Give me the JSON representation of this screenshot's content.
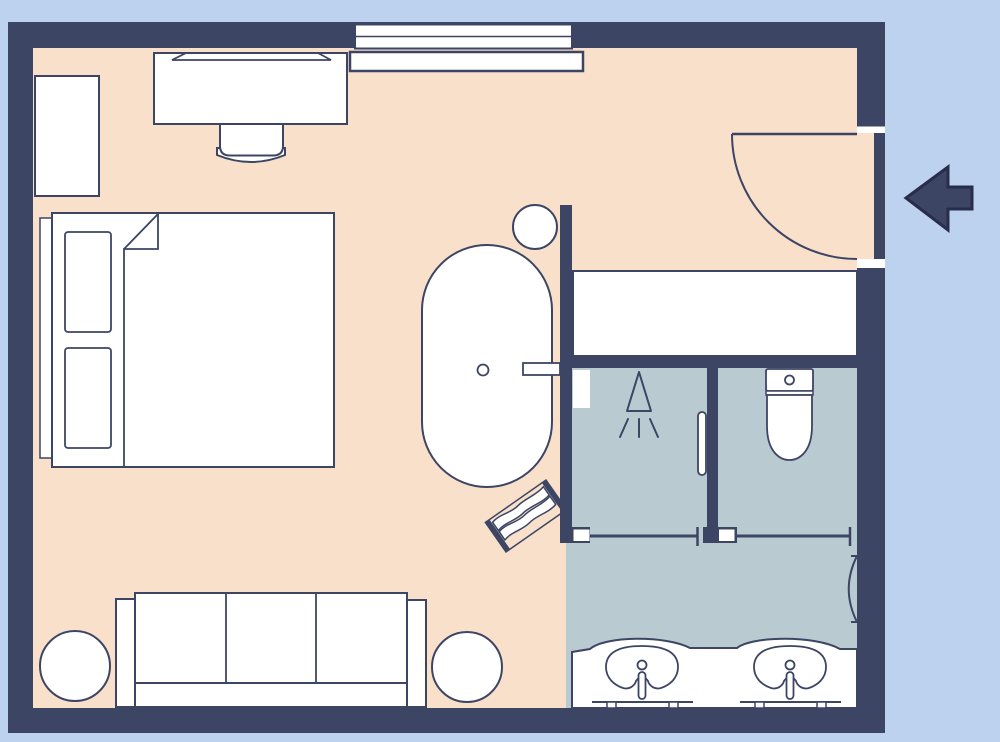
{
  "title": "apartment-floor-plan",
  "colors": {
    "outside": "#bdd2ee",
    "wall": "#3d4565",
    "floor_main": "#f8e0ca",
    "floor_bathroom": "#b9cad1",
    "furniture_fill": "#ffffff",
    "outline": "#3d4565",
    "arrow_outline": "#272d4a"
  },
  "rooms": [
    {
      "name": "bedroom-living-area",
      "floor": "peach",
      "furniture": [
        "dresser",
        "desk",
        "desk-chair",
        "window-shelf",
        "double-bed",
        "pillows",
        "folded-blanket",
        "sofa",
        "side-table-left",
        "side-table-right",
        "bathtub",
        "tub-side-stool",
        "tub-faucet-shelf",
        "bath-mat"
      ]
    },
    {
      "name": "entry-hall",
      "floor": "peach",
      "features": [
        "entry-swing-door"
      ]
    },
    {
      "name": "closet",
      "floor": "white",
      "features": []
    },
    {
      "name": "shower-room",
      "floor": "gray",
      "furniture": [
        "shower-head-symbol",
        "shower-niche",
        "door-handle"
      ],
      "features": [
        "sliding-door"
      ]
    },
    {
      "name": "wc-room",
      "floor": "gray",
      "furniture": [
        "toilet"
      ],
      "features": [
        "sliding-door"
      ]
    },
    {
      "name": "vanity-bathroom",
      "floor": "gray",
      "furniture": [
        "double-vanity-counter",
        "sink-left",
        "sink-right",
        "towel-rail"
      ]
    }
  ],
  "openings": {
    "window": {
      "wall": "top",
      "style": "double-line"
    },
    "entry_door": {
      "wall": "right",
      "type": "swing-door",
      "swing": "quarter-arc-inward"
    },
    "sliding_doors": 2
  },
  "entrance_marker": {
    "symbol": "block-arrow",
    "direction": "left",
    "meaning": "entrance from outside"
  },
  "counts": {
    "pillows": 2,
    "sofa_seat_cushions": 3,
    "sinks": 2,
    "side_tables": 2,
    "bath_rooms": 3
  }
}
